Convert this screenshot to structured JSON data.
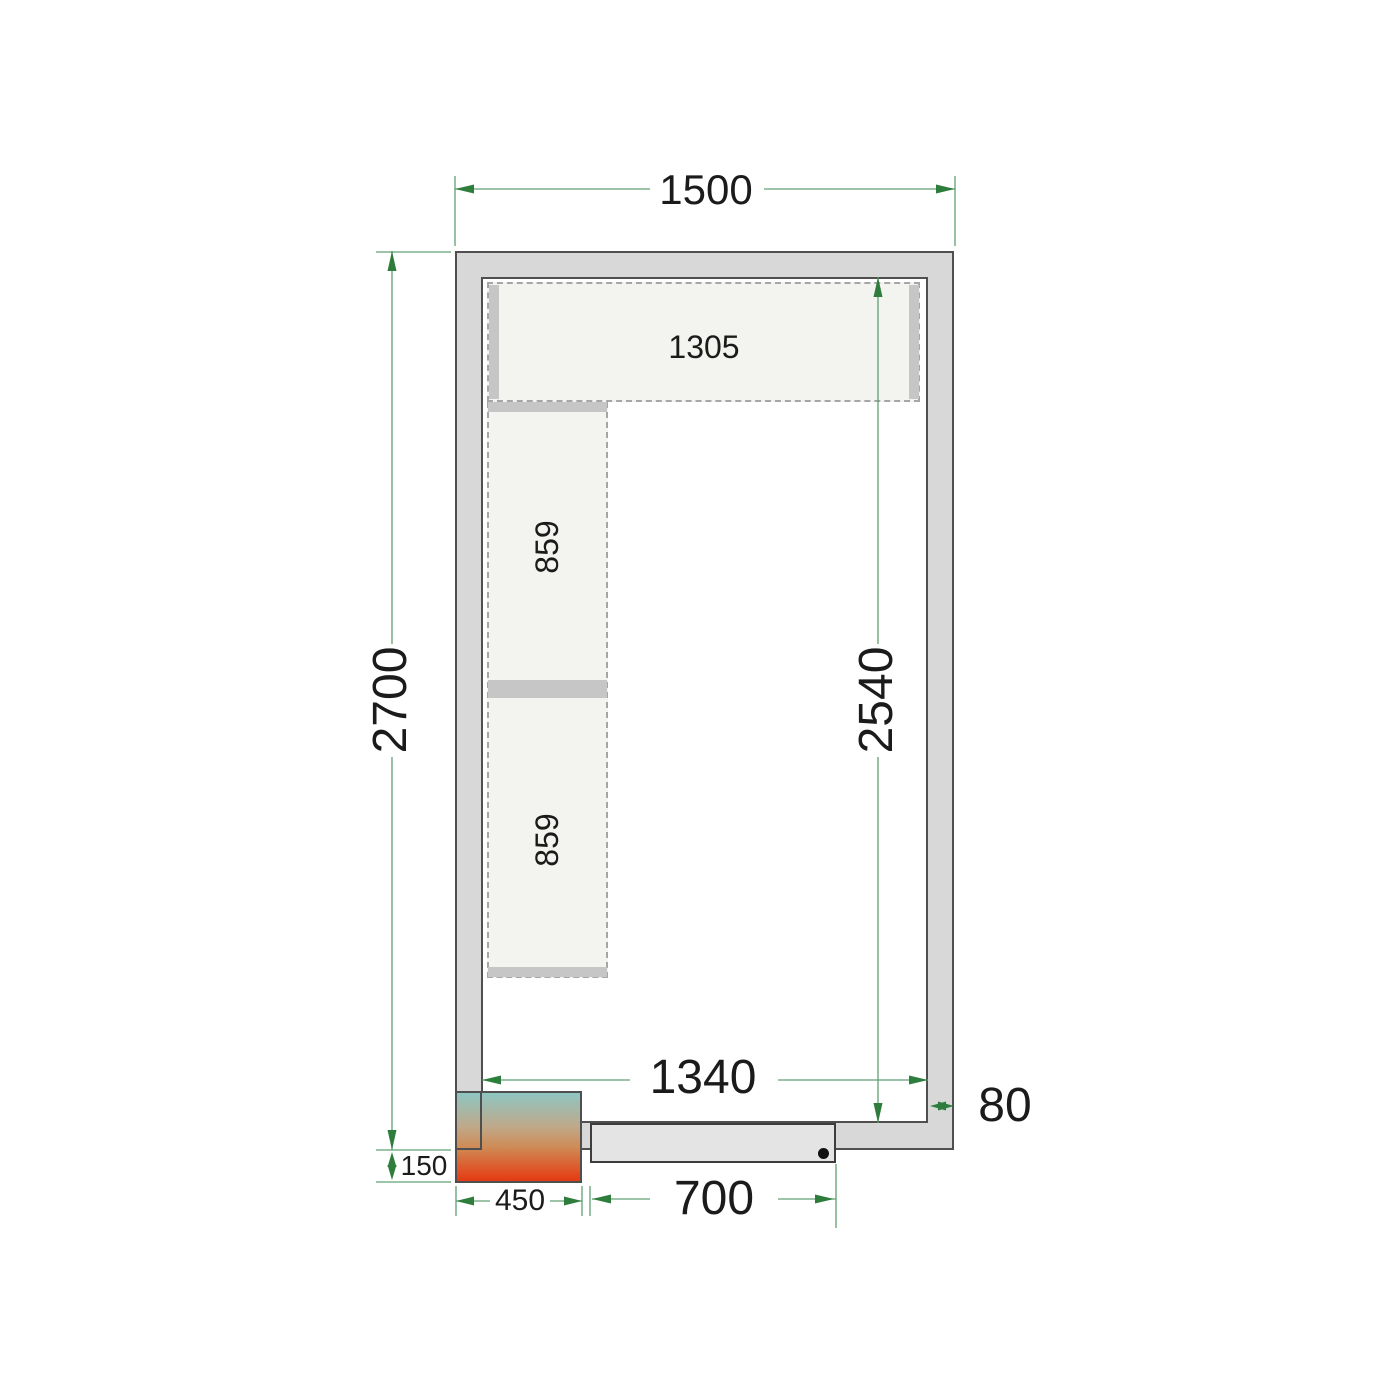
{
  "diagram": {
    "type": "cold-room-floor-plan"
  },
  "labels": {
    "overall_width": "1500",
    "overall_height": "2700",
    "inner_height": "2540",
    "inner_width": "1340",
    "wall_thickness": "80",
    "condenser_offset": "150",
    "condenser_width": "450",
    "door_width": "700",
    "shelf_top_length": "1305",
    "shelf_left_upper_length": "859",
    "shelf_left_lower_length": "859"
  },
  "colors": {
    "dimension_arrow_green": "#2e7d3c",
    "dimension_line_green": "#5fa074",
    "wall_fill": "#d8d8d8",
    "wall_border": "#4f4f4f",
    "room_fill": "#ffffff",
    "shelf_fill": "#f3f3f0",
    "shelf_support_bar": "#c6c6c6",
    "door_fill": "#e4e4e4",
    "handle_dot": "#111111",
    "unit_gradient_top": "#8ec6c2",
    "unit_gradient_bottom": "#e23c14",
    "label_text": "#1b1b1b"
  }
}
